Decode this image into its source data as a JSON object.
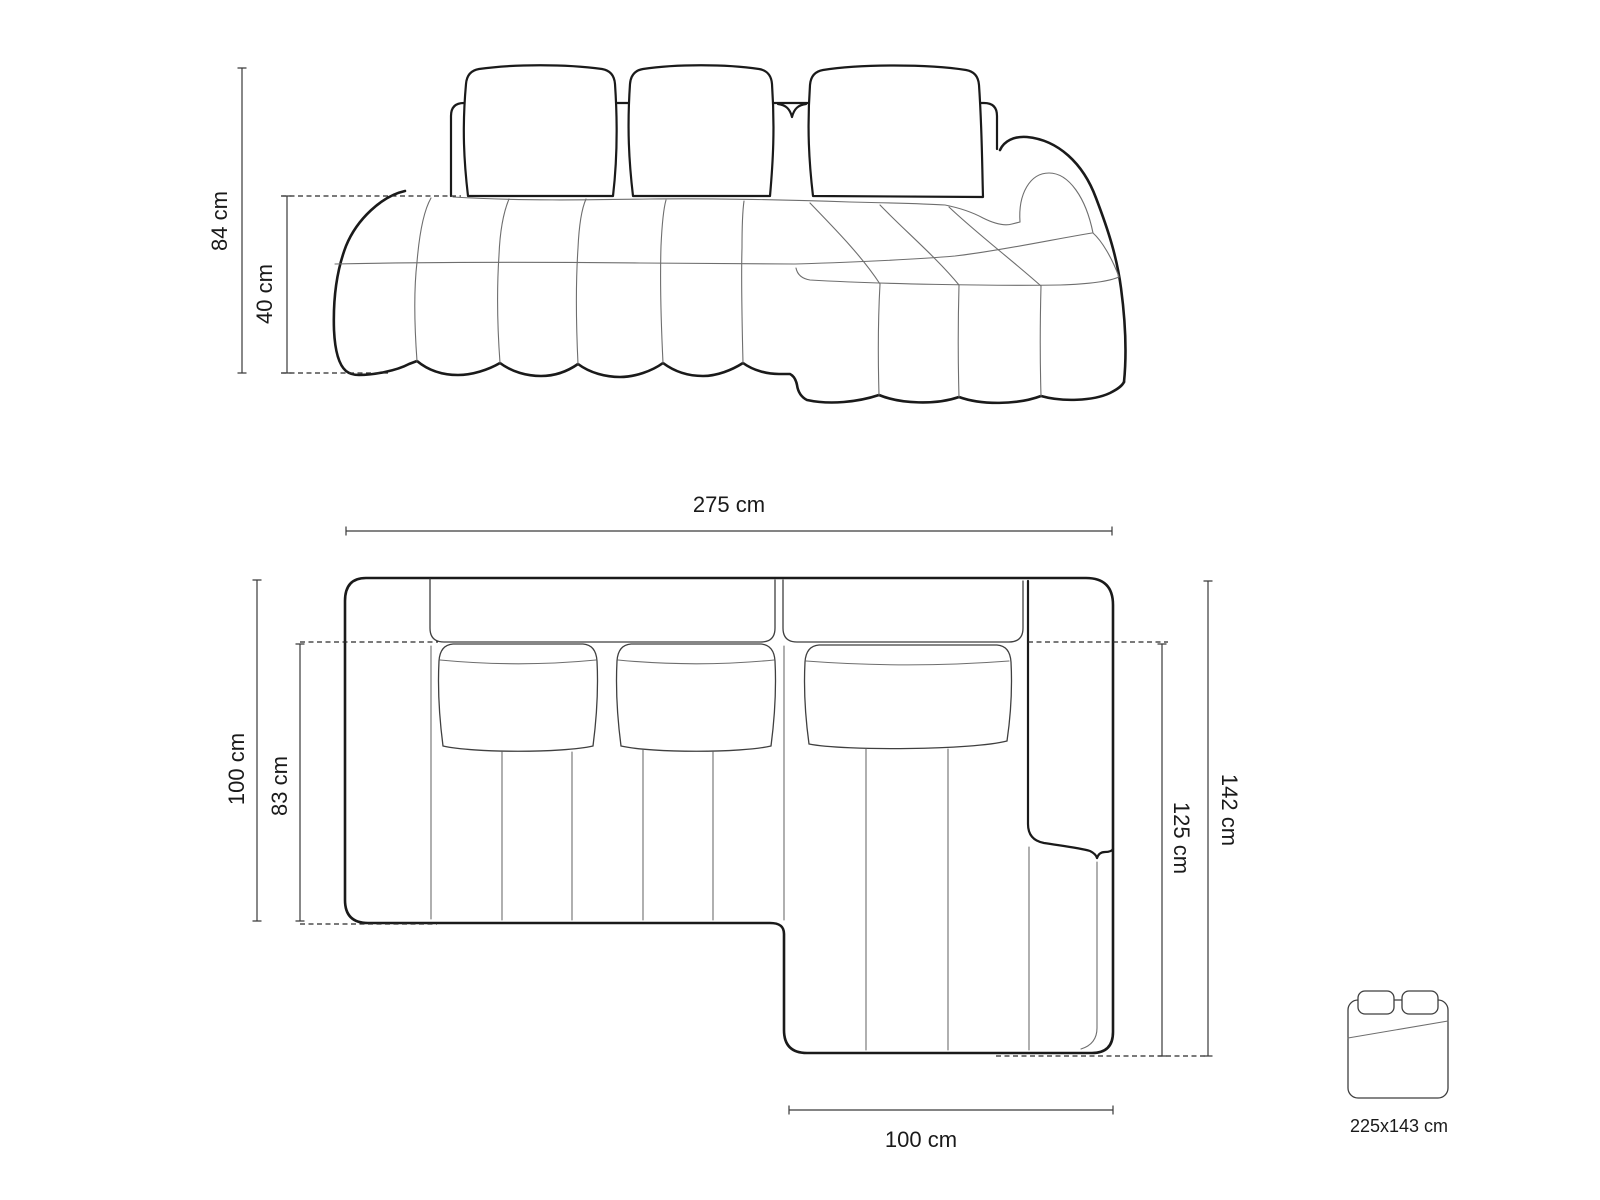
{
  "title": "corner-sofa-dimension-diagram",
  "colors": {
    "background": "#ffffff",
    "outline": "#1a1a1a",
    "seam": "#6e6e6e",
    "dimension": "#3a3a3a",
    "text": "#1a1a1a"
  },
  "front_view": {
    "dims": {
      "height": "84 cm",
      "seat_height": "40 cm"
    }
  },
  "plan_view": {
    "dims": {
      "total_width": "275 cm",
      "side_depth": "100 cm",
      "seat_depth": "83 cm",
      "total_depth": "142 cm",
      "chaise_depth": "125 cm",
      "chaise_width": "100 cm"
    }
  },
  "sleeping_area": {
    "size": "225x143 cm"
  }
}
